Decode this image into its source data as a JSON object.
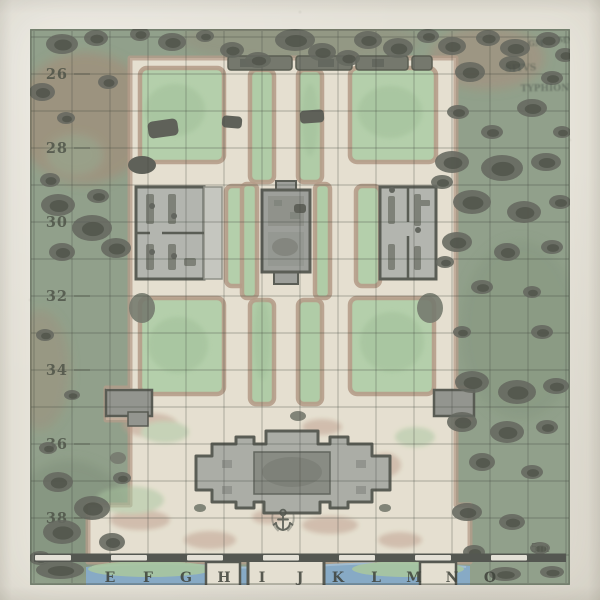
{
  "map": {
    "grid": {
      "column_labels": [
        "E",
        "F",
        "G",
        "H",
        "I",
        "J",
        "K",
        "L",
        "M",
        "N",
        "O"
      ],
      "row_labels": [
        "26",
        "28",
        "30",
        "32",
        "34",
        "36",
        "38"
      ]
    },
    "scale": {
      "label": "5m"
    },
    "icons": {
      "anchor": "anchor-icon"
    },
    "faint_annotations": [
      "GM",
      "MN",
      "SITVS",
      "TYPHION"
    ],
    "colors": {
      "paper": "#e9e6dc",
      "grass": "#8c9e86",
      "forest": "#5c6057",
      "forest_core": "#45483f",
      "earth": "#a3886f",
      "path": "#ebe4d2",
      "path_edge": "#b79a83",
      "garden": "#b2d2a8",
      "garden_dark": "#9dc295",
      "building": "#b2b5af",
      "building_dark": "#84877f",
      "wall": "#50534b",
      "water": "#7fa9cb",
      "shore": "#a5c89b",
      "seawall_dark": "#494d46",
      "seawall_light": "#e8e5da",
      "gridline": "#32362f",
      "label": "#3f4339"
    }
  }
}
